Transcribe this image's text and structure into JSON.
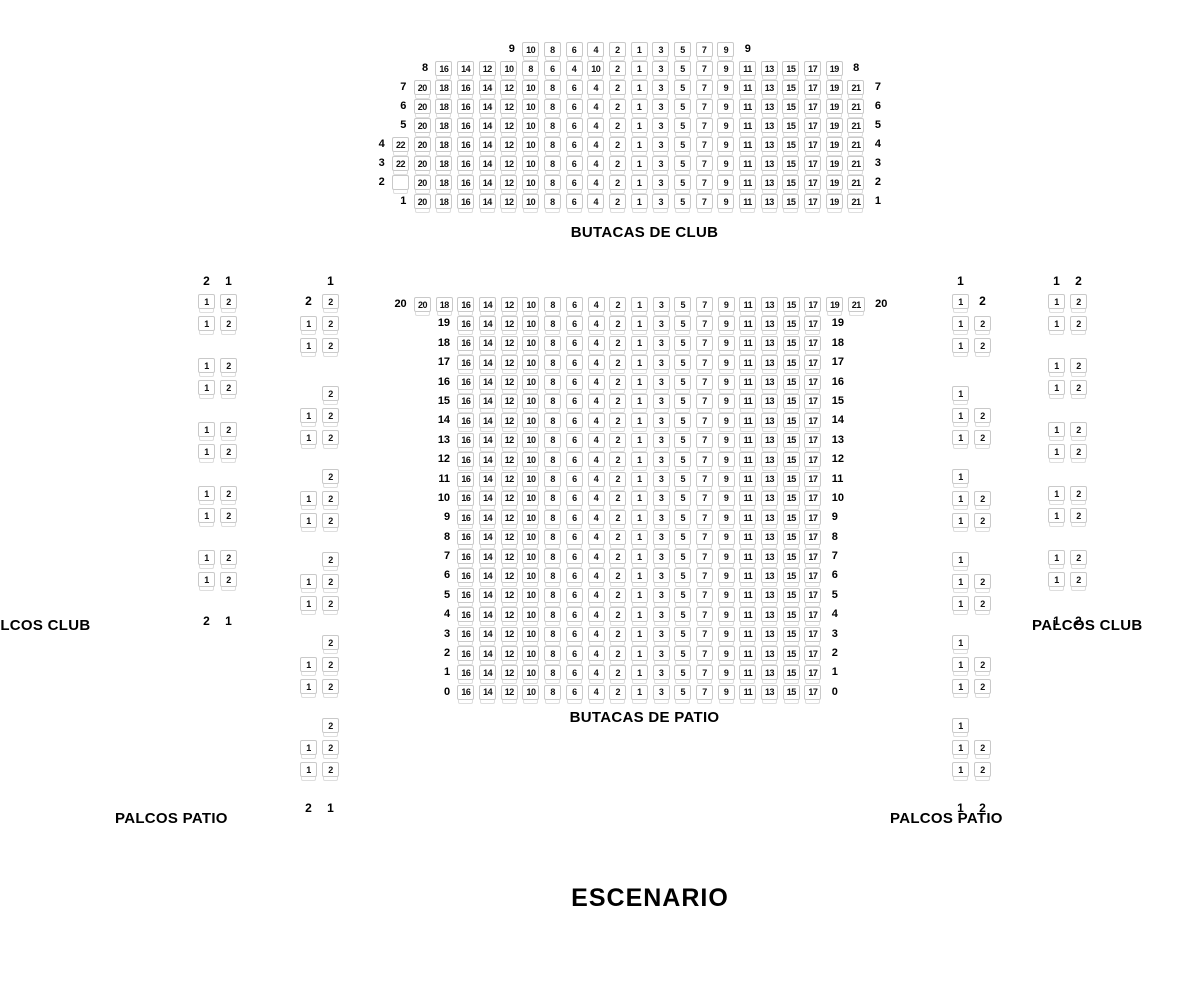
{
  "page": {
    "background": "#ffffff",
    "text_color": "#000000",
    "seat_border_color": "#c9c9c9",
    "seat_fill": "#ffffff"
  },
  "stage": {
    "label": "ESCENARIO"
  },
  "club": {
    "title": "BUTACAS DE CLUB",
    "rows": [
      {
        "label": "9",
        "start": 7,
        "seats": [
          "10",
          "8",
          "6",
          "4",
          "2",
          "1",
          "3",
          "5",
          "7",
          "9"
        ]
      },
      {
        "label": "8",
        "start": 3,
        "seats": [
          "16",
          "14",
          "12",
          "10",
          "8",
          "6",
          "4",
          "10",
          "2",
          "1",
          "3",
          "5",
          "7",
          "9",
          "11",
          "13",
          "15",
          "17",
          "19"
        ]
      },
      {
        "label": "7",
        "start": 2,
        "seats": [
          "20",
          "18",
          "16",
          "14",
          "12",
          "10",
          "8",
          "6",
          "4",
          "2",
          "1",
          "3",
          "5",
          "7",
          "9",
          "11",
          "13",
          "15",
          "17",
          "19",
          "21"
        ]
      },
      {
        "label": "6",
        "start": 2,
        "seats": [
          "20",
          "18",
          "16",
          "14",
          "12",
          "10",
          "8",
          "6",
          "4",
          "2",
          "1",
          "3",
          "5",
          "7",
          "9",
          "11",
          "13",
          "15",
          "17",
          "19",
          "21"
        ]
      },
      {
        "label": "5",
        "start": 2,
        "seats": [
          "20",
          "18",
          "16",
          "14",
          "12",
          "10",
          "8",
          "6",
          "4",
          "2",
          "1",
          "3",
          "5",
          "7",
          "9",
          "11",
          "13",
          "15",
          "17",
          "19",
          "21"
        ]
      },
      {
        "label": "4",
        "start": 1,
        "seats": [
          "22",
          "20",
          "18",
          "16",
          "14",
          "12",
          "10",
          "8",
          "6",
          "4",
          "2",
          "1",
          "3",
          "5",
          "7",
          "9",
          "11",
          "13",
          "15",
          "17",
          "19",
          "21"
        ]
      },
      {
        "label": "3",
        "start": 1,
        "seats": [
          "22",
          "20",
          "18",
          "16",
          "14",
          "12",
          "10",
          "8",
          "6",
          "4",
          "2",
          "1",
          "3",
          "5",
          "7",
          "9",
          "11",
          "13",
          "15",
          "17",
          "19",
          "21"
        ]
      },
      {
        "label": "2",
        "start": 1,
        "seats": [
          "",
          "20",
          "18",
          "16",
          "14",
          "12",
          "10",
          "8",
          "6",
          "4",
          "2",
          "1",
          "3",
          "5",
          "7",
          "9",
          "11",
          "13",
          "15",
          "17",
          "19",
          "21"
        ]
      },
      {
        "label": "1",
        "start": 2,
        "seats": [
          "20",
          "18",
          "16",
          "14",
          "12",
          "10",
          "8",
          "6",
          "4",
          "2",
          "1",
          "3",
          "5",
          "7",
          "9",
          "11",
          "13",
          "15",
          "17",
          "19",
          "21"
        ]
      }
    ]
  },
  "patio": {
    "title": "BUTACAS DE PATIO",
    "rows": [
      {
        "label": "20",
        "start": 1,
        "seats": [
          "20",
          "18",
          "16",
          "14",
          "12",
          "10",
          "8",
          "6",
          "4",
          "2",
          "1",
          "3",
          "5",
          "7",
          "9",
          "11",
          "13",
          "15",
          "17",
          "19",
          "21"
        ]
      },
      {
        "label": "19",
        "start": 3,
        "seats": [
          "16",
          "14",
          "12",
          "10",
          "8",
          "6",
          "4",
          "2",
          "1",
          "3",
          "5",
          "7",
          "9",
          "11",
          "13",
          "15",
          "17"
        ]
      },
      {
        "label": "18",
        "start": 3,
        "seats": [
          "16",
          "14",
          "12",
          "10",
          "8",
          "6",
          "4",
          "2",
          "1",
          "3",
          "5",
          "7",
          "9",
          "11",
          "13",
          "15",
          "17"
        ]
      },
      {
        "label": "17",
        "start": 3,
        "seats": [
          "16",
          "14",
          "12",
          "10",
          "8",
          "6",
          "4",
          "2",
          "1",
          "3",
          "5",
          "7",
          "9",
          "11",
          "13",
          "15",
          "17"
        ]
      },
      {
        "label": "16",
        "start": 3,
        "seats": [
          "16",
          "14",
          "12",
          "10",
          "8",
          "6",
          "4",
          "2",
          "1",
          "3",
          "5",
          "7",
          "9",
          "11",
          "13",
          "15",
          "17"
        ]
      },
      {
        "label": "15",
        "start": 3,
        "seats": [
          "16",
          "14",
          "12",
          "10",
          "8",
          "6",
          "4",
          "2",
          "1",
          "3",
          "5",
          "7",
          "9",
          "11",
          "13",
          "15",
          "17"
        ]
      },
      {
        "label": "14",
        "start": 3,
        "seats": [
          "16",
          "14",
          "12",
          "10",
          "8",
          "6",
          "4",
          "2",
          "1",
          "3",
          "5",
          "7",
          "9",
          "11",
          "13",
          "15",
          "17"
        ]
      },
      {
        "label": "13",
        "start": 3,
        "seats": [
          "16",
          "14",
          "12",
          "10",
          "8",
          "6",
          "4",
          "2",
          "1",
          "3",
          "5",
          "7",
          "9",
          "11",
          "13",
          "15",
          "17"
        ]
      },
      {
        "label": "12",
        "start": 3,
        "seats": [
          "16",
          "14",
          "12",
          "10",
          "8",
          "6",
          "4",
          "2",
          "1",
          "3",
          "5",
          "7",
          "9",
          "11",
          "13",
          "15",
          "17"
        ]
      },
      {
        "label": "11",
        "start": 3,
        "seats": [
          "16",
          "14",
          "12",
          "10",
          "8",
          "6",
          "4",
          "2",
          "1",
          "3",
          "5",
          "7",
          "9",
          "11",
          "13",
          "15",
          "17"
        ]
      },
      {
        "label": "10",
        "start": 3,
        "seats": [
          "16",
          "14",
          "12",
          "10",
          "8",
          "6",
          "4",
          "2",
          "1",
          "3",
          "5",
          "7",
          "9",
          "11",
          "13",
          "15",
          "17"
        ]
      },
      {
        "label": "9",
        "start": 3,
        "seats": [
          "16",
          "14",
          "12",
          "10",
          "8",
          "6",
          "4",
          "2",
          "1",
          "3",
          "5",
          "7",
          "9",
          "11",
          "13",
          "15",
          "17"
        ]
      },
      {
        "label": "8",
        "start": 3,
        "seats": [
          "16",
          "14",
          "12",
          "10",
          "8",
          "6",
          "4",
          "2",
          "1",
          "3",
          "5",
          "7",
          "9",
          "11",
          "13",
          "15",
          "17"
        ]
      },
      {
        "label": "7",
        "start": 3,
        "seats": [
          "16",
          "14",
          "12",
          "10",
          "8",
          "6",
          "4",
          "2",
          "1",
          "3",
          "5",
          "7",
          "9",
          "11",
          "13",
          "15",
          "17"
        ]
      },
      {
        "label": "6",
        "start": 3,
        "seats": [
          "16",
          "14",
          "12",
          "10",
          "8",
          "6",
          "4",
          "2",
          "1",
          "3",
          "5",
          "7",
          "9",
          "11",
          "13",
          "15",
          "17"
        ]
      },
      {
        "label": "5",
        "start": 3,
        "seats": [
          "16",
          "14",
          "12",
          "10",
          "8",
          "6",
          "4",
          "2",
          "1",
          "3",
          "5",
          "7",
          "9",
          "11",
          "13",
          "15",
          "17"
        ]
      },
      {
        "label": "4",
        "start": 3,
        "seats": [
          "16",
          "14",
          "12",
          "10",
          "8",
          "6",
          "4",
          "2",
          "1",
          "3",
          "5",
          "7",
          "9",
          "11",
          "13",
          "15",
          "17"
        ]
      },
      {
        "label": "3",
        "start": 3,
        "seats": [
          "16",
          "14",
          "12",
          "10",
          "8",
          "6",
          "4",
          "2",
          "1",
          "3",
          "5",
          "7",
          "9",
          "11",
          "13",
          "15",
          "17"
        ]
      },
      {
        "label": "2",
        "start": 3,
        "seats": [
          "16",
          "14",
          "12",
          "10",
          "8",
          "6",
          "4",
          "2",
          "1",
          "3",
          "5",
          "7",
          "9",
          "11",
          "13",
          "15",
          "17"
        ]
      },
      {
        "label": "1",
        "start": 3,
        "seats": [
          "16",
          "14",
          "12",
          "10",
          "8",
          "6",
          "4",
          "2",
          "1",
          "3",
          "5",
          "7",
          "9",
          "11",
          "13",
          "15",
          "17"
        ]
      },
      {
        "label": "0",
        "start": 3,
        "seats": [
          "16",
          "14",
          "12",
          "10",
          "8",
          "6",
          "4",
          "2",
          "1",
          "3",
          "5",
          "7",
          "9",
          "11",
          "13",
          "15",
          "17"
        ]
      }
    ]
  },
  "palcos": {
    "club_left_label": "PALCOS CLUB",
    "club_right_label": "PALCOS CLUB",
    "patio_left_label": "PALCOS PATIO",
    "patio_right_label": "PALCOS PATIO",
    "left_outer": {
      "header": [
        "l:2",
        "l:1"
      ],
      "groups": [
        {
          "rows": [
            [
              "s:1",
              "s:2"
            ],
            [
              "s:1",
              "s:2"
            ]
          ]
        },
        {
          "rows": [
            [
              "s:1",
              "s:2"
            ],
            [
              "s:1",
              "s:2"
            ]
          ]
        },
        {
          "rows": [
            [
              "s:1",
              "s:2"
            ],
            [
              "s:1",
              "s:2"
            ]
          ]
        },
        {
          "rows": [
            [
              "s:1",
              "s:2"
            ],
            [
              "s:1",
              "s:2"
            ]
          ]
        },
        {
          "rows": [
            [
              "s:1",
              "s:2"
            ],
            [
              "s:1",
              "s:2"
            ]
          ]
        }
      ],
      "footer": [
        "l:2",
        "l:1"
      ]
    },
    "left_inner": {
      "header": [
        "",
        "l:1"
      ],
      "groups": [
        {
          "rows": [
            [
              "l:2",
              "s:2"
            ],
            [
              "s:1",
              "s:2"
            ],
            [
              "s:1",
              "s:2"
            ]
          ]
        },
        {
          "rows": [
            [
              "",
              "s:2"
            ],
            [
              "s:1",
              "s:2"
            ],
            [
              "s:1",
              "s:2"
            ]
          ]
        },
        {
          "rows": [
            [
              "",
              "s:2"
            ],
            [
              "s:1",
              "s:2"
            ],
            [
              "s:1",
              "s:2"
            ]
          ]
        },
        {
          "rows": [
            [
              "",
              "s:2"
            ],
            [
              "s:1",
              "s:2"
            ],
            [
              "s:1",
              "s:2"
            ]
          ]
        },
        {
          "rows": [
            [
              "",
              "s:2"
            ],
            [
              "s:1",
              "s:2"
            ],
            [
              "s:1",
              "s:2"
            ]
          ]
        },
        {
          "rows": [
            [
              "",
              "s:2"
            ],
            [
              "s:1",
              "s:2"
            ],
            [
              "s:1",
              "s:2"
            ]
          ]
        }
      ],
      "footer": [
        "l:2",
        "l:1"
      ]
    },
    "right_inner": {
      "header": [
        "l:1",
        ""
      ],
      "groups": [
        {
          "rows": [
            [
              "s:1",
              "l:2"
            ],
            [
              "s:1",
              "s:2"
            ],
            [
              "s:1",
              "s:2"
            ]
          ]
        },
        {
          "rows": [
            [
              "s:1",
              ""
            ],
            [
              "s:1",
              "s:2"
            ],
            [
              "s:1",
              "s:2"
            ]
          ]
        },
        {
          "rows": [
            [
              "s:1",
              ""
            ],
            [
              "s:1",
              "s:2"
            ],
            [
              "s:1",
              "s:2"
            ]
          ]
        },
        {
          "rows": [
            [
              "s:1",
              ""
            ],
            [
              "s:1",
              "s:2"
            ],
            [
              "s:1",
              "s:2"
            ]
          ]
        },
        {
          "rows": [
            [
              "s:1",
              ""
            ],
            [
              "s:1",
              "s:2"
            ],
            [
              "s:1",
              "s:2"
            ]
          ]
        },
        {
          "rows": [
            [
              "s:1",
              ""
            ],
            [
              "s:1",
              "s:2"
            ],
            [
              "s:1",
              "s:2"
            ]
          ]
        }
      ],
      "footer": [
        "l:1",
        "l:2"
      ]
    },
    "right_outer": {
      "header": [
        "l:1",
        "l:2"
      ],
      "groups": [
        {
          "rows": [
            [
              "s:1",
              "s:2"
            ],
            [
              "s:1",
              "s:2"
            ]
          ]
        },
        {
          "rows": [
            [
              "s:1",
              "s:2"
            ],
            [
              "s:1",
              "s:2"
            ]
          ]
        },
        {
          "rows": [
            [
              "s:1",
              "s:2"
            ],
            [
              "s:1",
              "s:2"
            ]
          ]
        },
        {
          "rows": [
            [
              "s:1",
              "s:2"
            ],
            [
              "s:1",
              "s:2"
            ]
          ]
        },
        {
          "rows": [
            [
              "s:1",
              "s:2"
            ],
            [
              "s:1",
              "s:2"
            ]
          ]
        }
      ],
      "footer": [
        "l:1",
        "l:2"
      ]
    }
  }
}
